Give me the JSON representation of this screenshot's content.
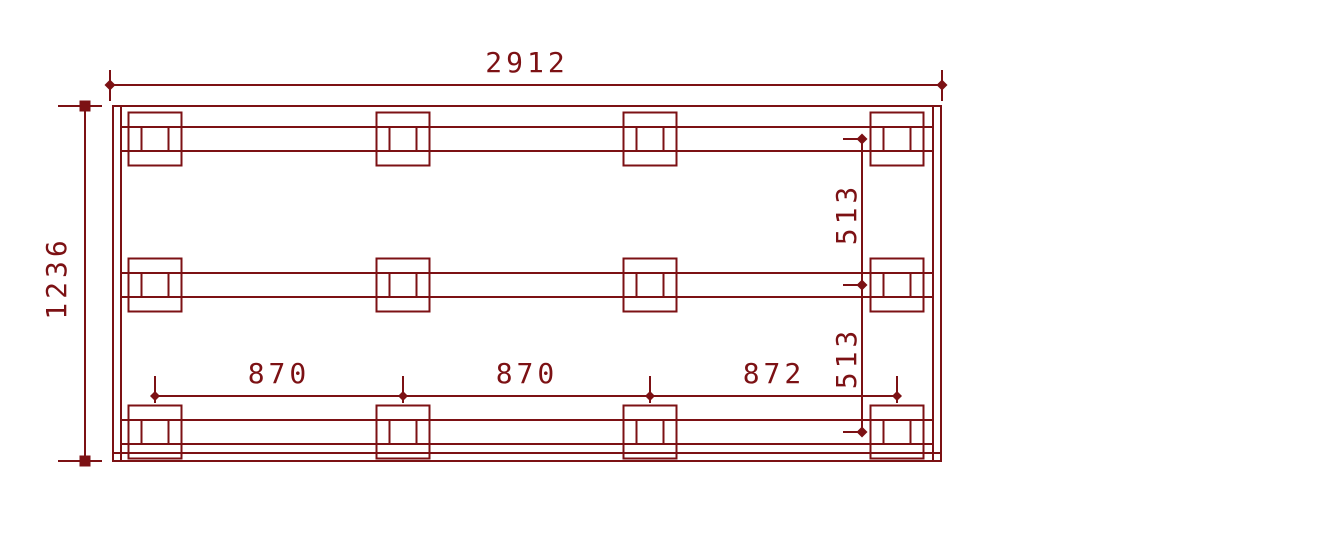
{
  "drawing": {
    "kind": "cad-technical-drawing",
    "view": "pallet-frame-top-view",
    "line_color": "#7c1114",
    "background_color": "#ffffff",
    "labels": {
      "overall_width": "2912",
      "overall_height": "1236",
      "span_1": "870",
      "span_2": "870",
      "span_3": "872",
      "rail_gap_1": "513",
      "rail_gap_2": "513"
    },
    "structure": {
      "rail_count": 3,
      "block_columns": 4,
      "total_blocks": 12
    },
    "dimension_values": {
      "overall_width": 2912,
      "overall_height": 1236,
      "block_column_spacings": [
        870,
        870,
        872
      ],
      "rail_center_spacings": [
        513,
        513
      ]
    }
  }
}
